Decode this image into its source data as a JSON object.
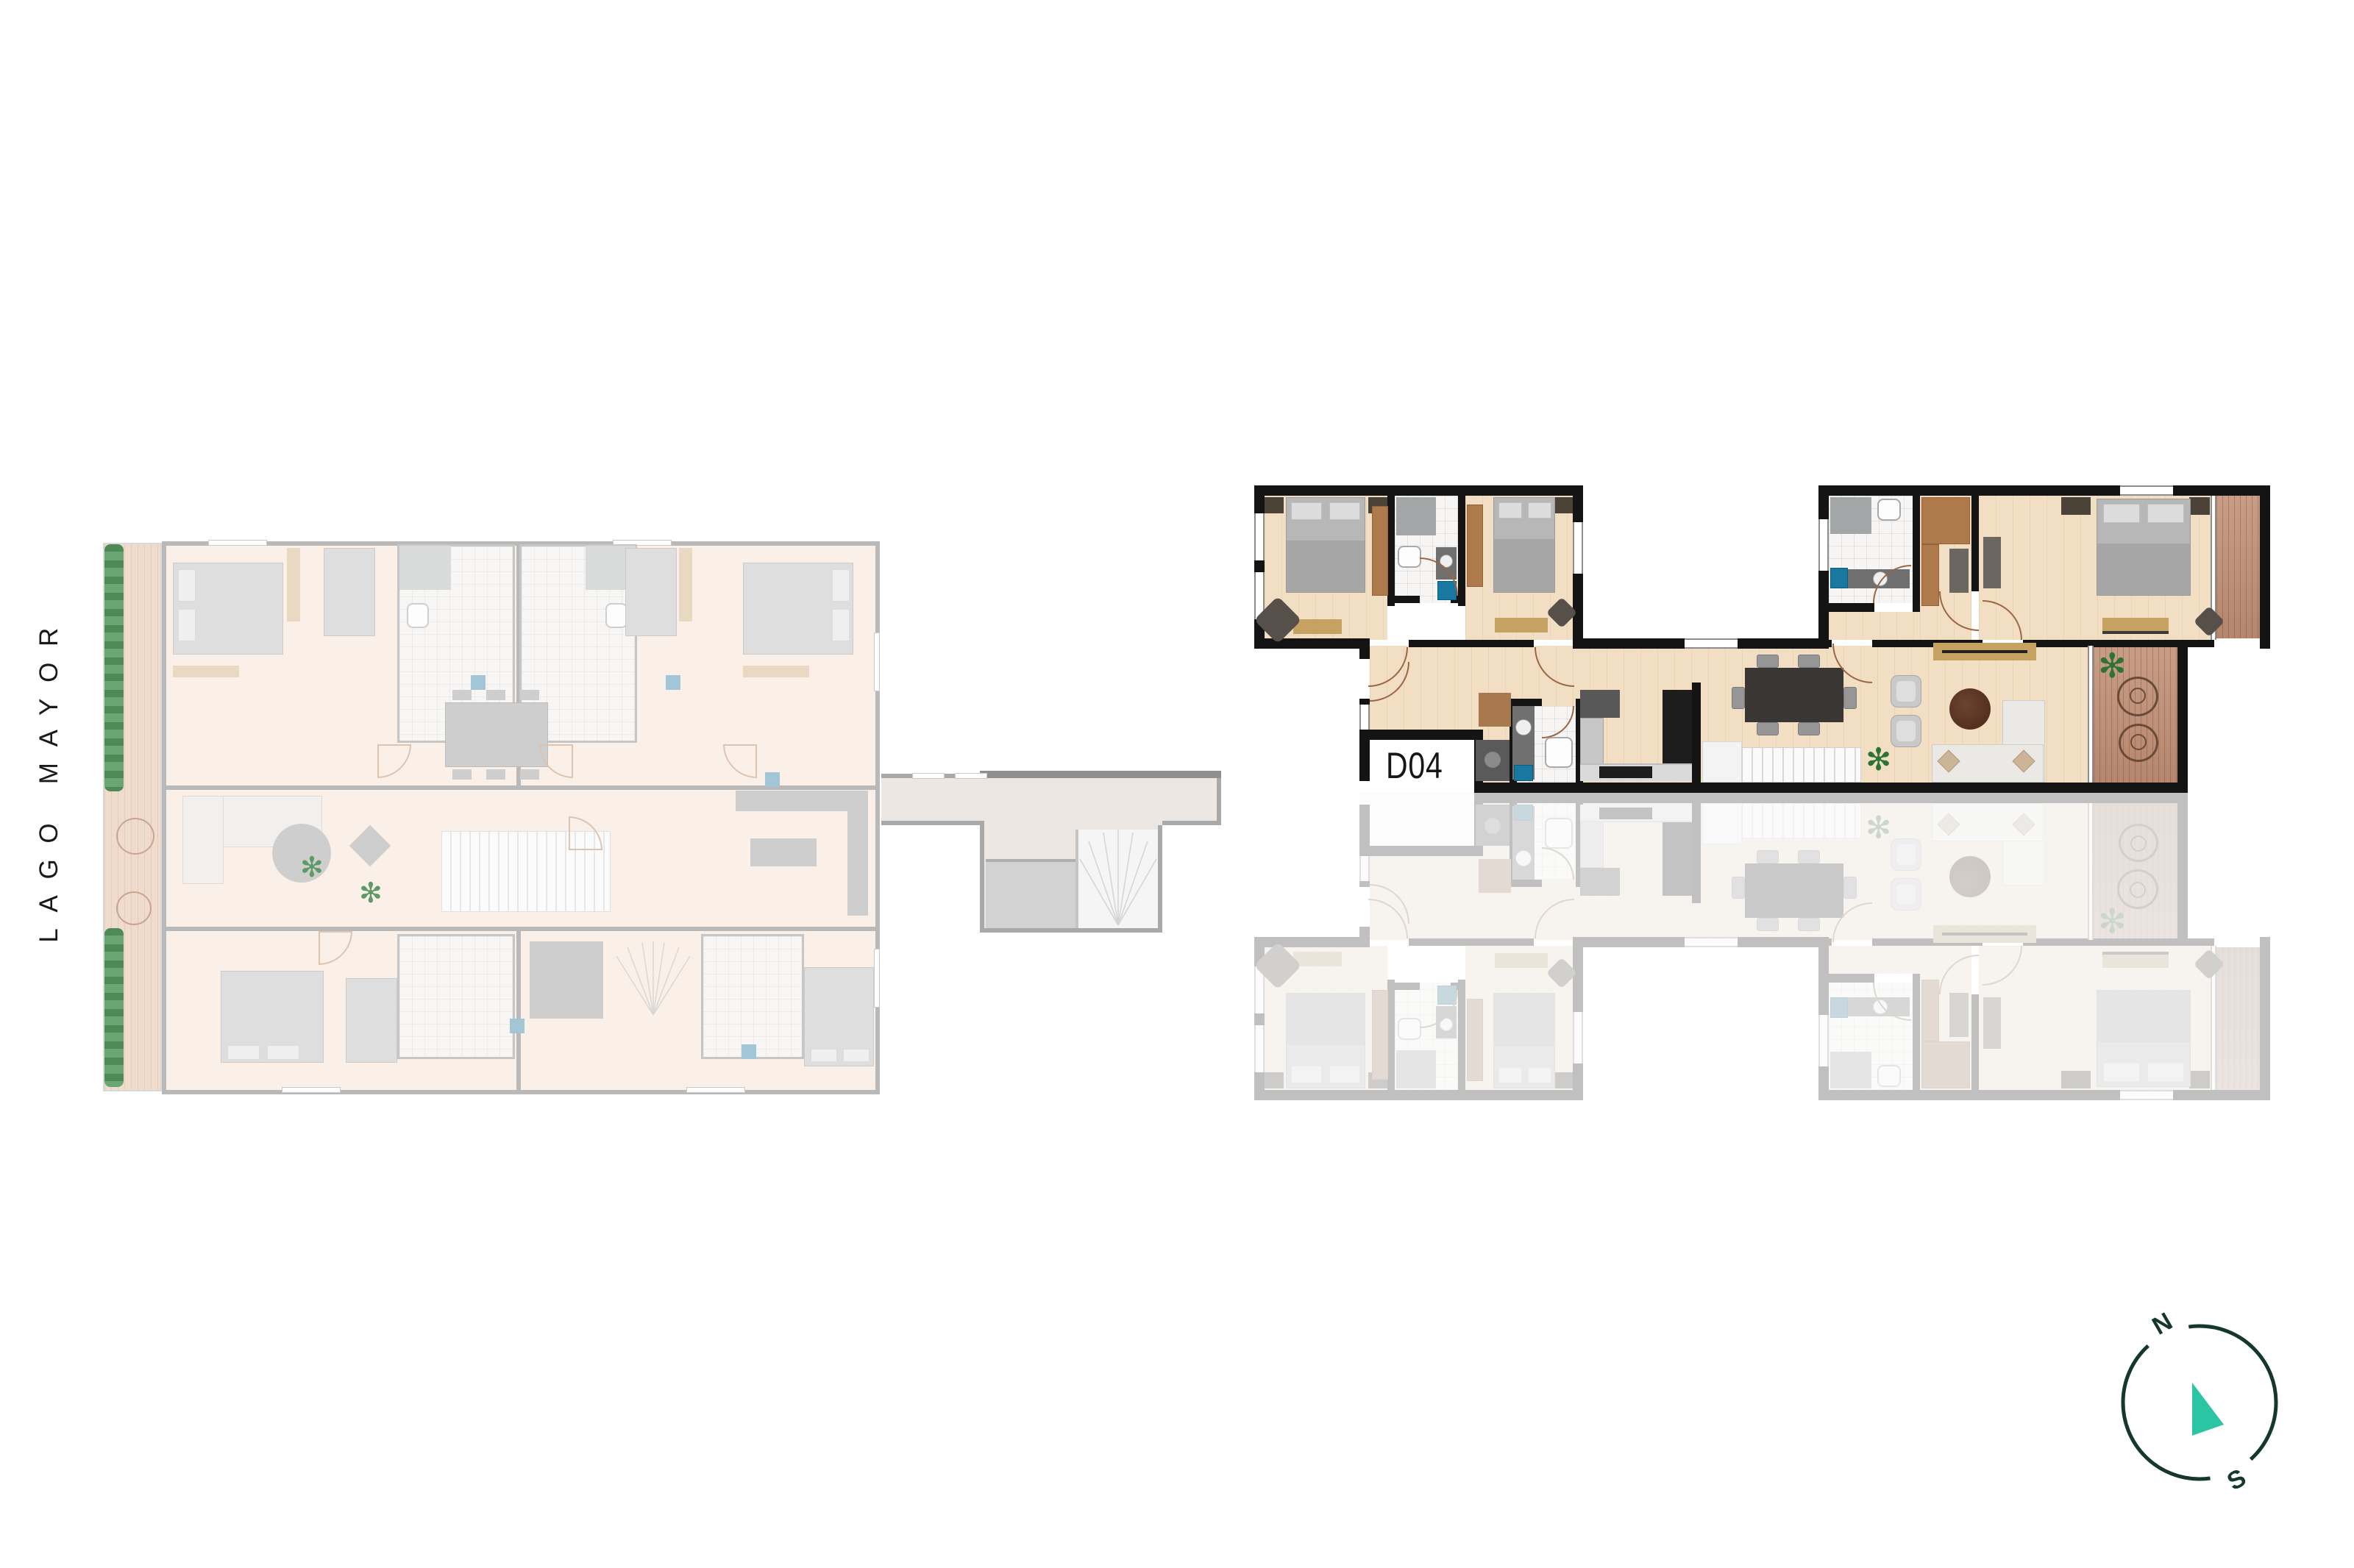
{
  "labels": {
    "project": "LAGO MAYOR",
    "unit": "D04"
  },
  "compass": {
    "north": "N",
    "south": "S"
  },
  "icons": {
    "plant": "✻"
  },
  "palette": {
    "background": "#ffffff",
    "wall": "#141414",
    "wood_floor": "#f2dfc3",
    "deck_wood": "#c18f75",
    "wardrobe_brown": "#ae7a4b",
    "bench_tan": "#c5a162",
    "bed_grey": "#b7b7b7",
    "sofa_grey": "#ebe9e5",
    "dining_table": "#3a3633",
    "coffee_table": "#5b3425",
    "accent_blue": "#1878a0",
    "plant_green": "#2c7335",
    "faded_wall": "#b9b9b9",
    "faded_floor": "#faf0e8",
    "compass_ring": "#14382e",
    "compass_needle": "#2bc5a3",
    "label_color": "#1a1a1a"
  }
}
